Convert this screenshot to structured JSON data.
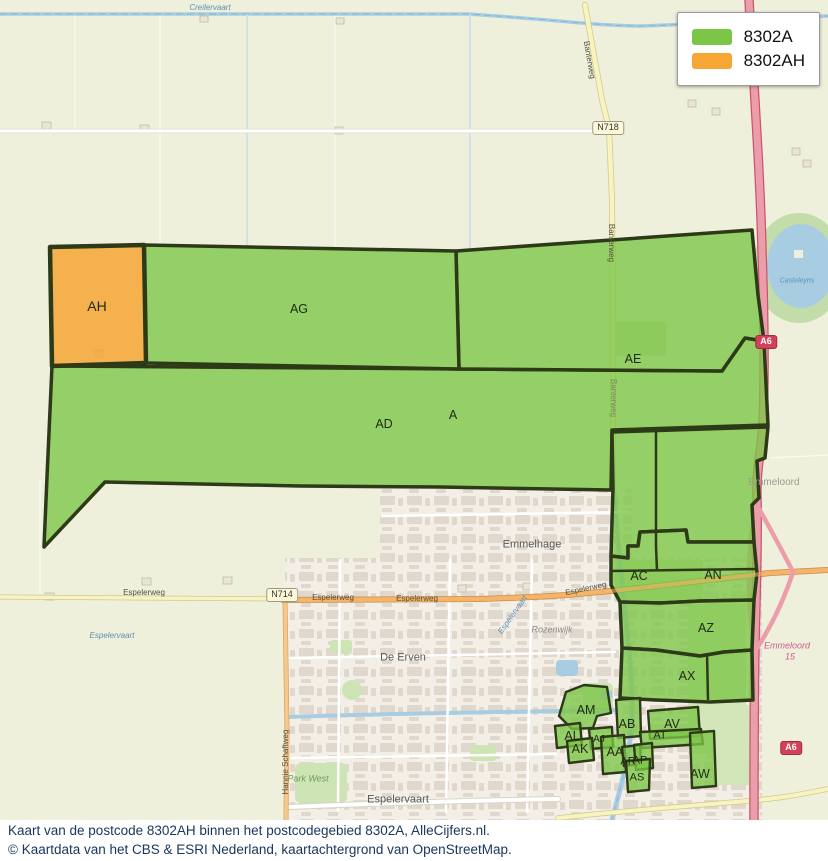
{
  "legend": {
    "items": [
      {
        "label": "8302A",
        "color": "#7cc547"
      },
      {
        "label": "8302AH",
        "color": "#f5a635"
      }
    ]
  },
  "caption": {
    "line1": "Kaart van de postcode 8302AH binnen het postcodegebied 8302A, AlleCijfers.nl.",
    "line2": "© Kaartdata van het CBS & ESRI Nederland, kaartachtergrond van OpenStreetMap."
  },
  "colors": {
    "postcode_area_green": "#7cc547",
    "postcode_target_orange": "#f5a635",
    "polygon_border": "#2d3a17",
    "motorway_pink": "#ec9dab",
    "caption_text": "#17365d"
  },
  "map": {
    "labels": [
      {
        "text": "AH",
        "x": 97,
        "y": 306,
        "kind": "region",
        "size": 14,
        "name": "region-label-ah"
      },
      {
        "text": "AG",
        "x": 299,
        "y": 309,
        "kind": "region",
        "name": "region-label-ag"
      },
      {
        "text": "AE",
        "x": 633,
        "y": 359,
        "kind": "region",
        "name": "region-label-ae"
      },
      {
        "text": "AD",
        "x": 384,
        "y": 424,
        "kind": "region",
        "name": "region-label-ad"
      },
      {
        "text": "A",
        "x": 453,
        "y": 415,
        "kind": "region",
        "name": "region-label-a"
      },
      {
        "text": "AC",
        "x": 639,
        "y": 576,
        "kind": "region",
        "name": "region-label-ac"
      },
      {
        "text": "AN",
        "x": 713,
        "y": 575,
        "kind": "region",
        "name": "region-label-an"
      },
      {
        "text": "AZ",
        "x": 706,
        "y": 628,
        "kind": "region",
        "name": "region-label-az"
      },
      {
        "text": "AX",
        "x": 687,
        "y": 676,
        "kind": "region",
        "name": "region-label-ax"
      },
      {
        "text": "AM",
        "x": 586,
        "y": 710,
        "kind": "region",
        "name": "region-label-am"
      },
      {
        "text": "AB",
        "x": 627,
        "y": 724,
        "kind": "region",
        "name": "region-label-ab"
      },
      {
        "text": "AV",
        "x": 672,
        "y": 724,
        "kind": "region",
        "name": "region-label-av"
      },
      {
        "text": "AT",
        "x": 660,
        "y": 736,
        "kind": "region",
        "size": 11,
        "name": "region-label-at"
      },
      {
        "text": "AL",
        "x": 572,
        "y": 736,
        "kind": "region",
        "name": "region-label-al"
      },
      {
        "text": "AJ",
        "x": 599,
        "y": 740,
        "kind": "region",
        "size": 10,
        "name": "region-label-aj"
      },
      {
        "text": "AK",
        "x": 580,
        "y": 749,
        "kind": "region",
        "name": "region-label-ak"
      },
      {
        "text": "AA",
        "x": 615,
        "y": 752,
        "kind": "region",
        "name": "region-label-aa"
      },
      {
        "text": "AR",
        "x": 628,
        "y": 762,
        "kind": "region",
        "size": 11,
        "name": "region-label-ar"
      },
      {
        "text": "AP",
        "x": 640,
        "y": 761,
        "kind": "region",
        "size": 11,
        "name": "region-label-ap"
      },
      {
        "text": "AS",
        "x": 637,
        "y": 778,
        "kind": "region",
        "size": 11,
        "name": "region-label-as"
      },
      {
        "text": "AW",
        "x": 700,
        "y": 774,
        "kind": "region",
        "name": "region-label-aw"
      },
      {
        "text": "Creilervaart",
        "x": 210,
        "y": 8,
        "kind": "water",
        "name": "water-label-creilervaart"
      },
      {
        "text": "Espelervaart",
        "x": 112,
        "y": 636,
        "kind": "water",
        "name": "water-label-espelervaart-west"
      },
      {
        "text": "Espelervaart",
        "x": 513,
        "y": 615,
        "kind": "water",
        "rot": -55,
        "name": "water-label-espelervaart-canal"
      },
      {
        "text": "Casteleyns",
        "x": 797,
        "y": 281,
        "kind": "water",
        "size": 7,
        "name": "water-label-casteleyns"
      },
      {
        "text": "Emmelhage",
        "x": 532,
        "y": 545,
        "kind": "place",
        "name": "place-label-emmelhage"
      },
      {
        "text": "De Erven",
        "x": 403,
        "y": 658,
        "kind": "place",
        "name": "place-label-de-erven"
      },
      {
        "text": "Rozenwijk",
        "x": 552,
        "y": 630,
        "kind": "place-sm",
        "name": "place-label-rozenwijk"
      },
      {
        "text": "Park West",
        "x": 308,
        "y": 779,
        "kind": "park",
        "name": "place-label-park-west"
      },
      {
        "text": "Espelervaart",
        "x": 398,
        "y": 800,
        "kind": "place",
        "name": "place-label-espelervaart-district"
      },
      {
        "text": "Emmeloord",
        "x": 774,
        "y": 483,
        "kind": "faded",
        "name": "place-label-emmeloord"
      },
      {
        "text": "Emmeloord",
        "x": 787,
        "y": 646,
        "kind": "dest",
        "name": "dest-label-emmeloord"
      },
      {
        "text": "15",
        "x": 790,
        "y": 657,
        "kind": "dest",
        "name": "dest-label-exit-15"
      },
      {
        "text": "Espelerweg",
        "x": 144,
        "y": 593,
        "kind": "street",
        "name": "street-label-espelerweg-1"
      },
      {
        "text": "Espelerweg",
        "x": 333,
        "y": 598,
        "kind": "street",
        "name": "street-label-espelerweg-2"
      },
      {
        "text": "Espelerweg",
        "x": 417,
        "y": 599,
        "kind": "street",
        "name": "street-label-espelerweg-3"
      },
      {
        "text": "Espelerweg",
        "x": 586,
        "y": 589,
        "kind": "street",
        "rot": -12,
        "name": "street-label-espelerweg-4"
      },
      {
        "text": "Banterweg",
        "x": 589,
        "y": 60,
        "kind": "street",
        "rot": 80,
        "name": "street-label-banterweg-1"
      },
      {
        "text": "Banterweg",
        "x": 611,
        "y": 243,
        "kind": "street",
        "rot": 90,
        "name": "street-label-banterweg-2"
      },
      {
        "text": "Banterweg",
        "x": 613,
        "y": 398,
        "kind": "street-faded",
        "rot": 90,
        "name": "street-label-banterweg-3"
      },
      {
        "text": "Hannie Schaftweg",
        "x": 286,
        "y": 762,
        "kind": "street",
        "rot": -90,
        "name": "street-label-hannie-schaftweg"
      }
    ],
    "shields": [
      {
        "text": "N718",
        "x": 608,
        "y": 128,
        "type": "provincial",
        "name": "road-shield-n718"
      },
      {
        "text": "N714",
        "x": 282,
        "y": 595,
        "type": "provincial",
        "name": "road-shield-n714"
      },
      {
        "text": "A6",
        "x": 766,
        "y": 342,
        "type": "motorway",
        "name": "road-shield-a6-north"
      },
      {
        "text": "A6",
        "x": 791,
        "y": 748,
        "type": "motorway",
        "name": "road-shield-a6-south"
      }
    ]
  }
}
